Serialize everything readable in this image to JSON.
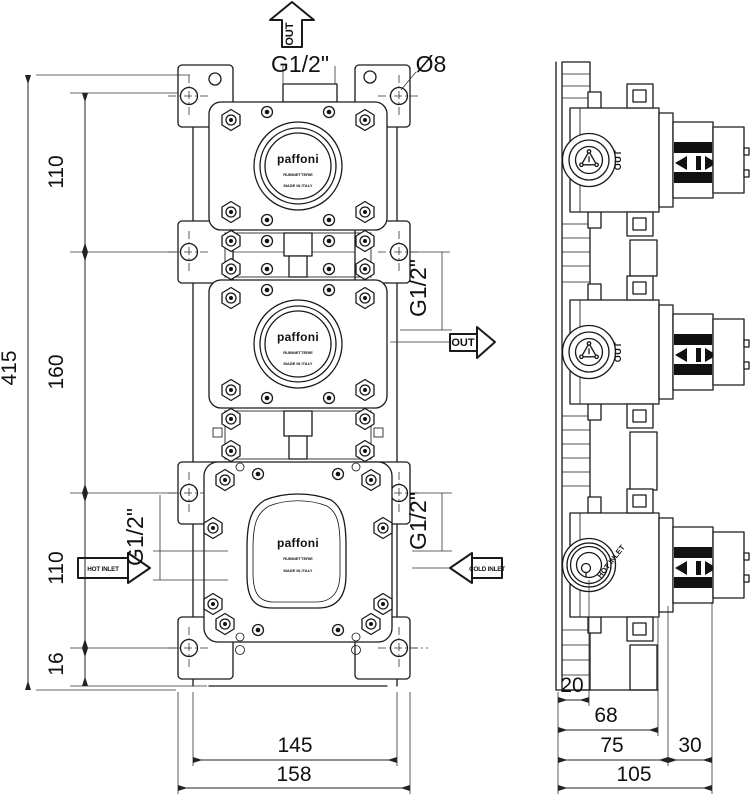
{
  "product": {
    "brand": "paffoni",
    "brand_sub": "RUBINETTERIE",
    "brand_origin": "MADE IN ITALY"
  },
  "labels": {
    "thread": "G1/2\"",
    "hole_diameter": "Ø8",
    "out": "OUT",
    "hot_inlet": "HOT INLET",
    "cold_inlet": "COLD INLET"
  },
  "dimensions_front_mm": {
    "total_height": "415",
    "spacing_top": "110",
    "spacing_middle": "160",
    "spacing_bottom": "110",
    "foot": "16",
    "inner_width": "145",
    "overall_width": "158"
  },
  "dimensions_side_mm": {
    "port_plane_offset": "20",
    "body_depth": "68",
    "rough_in_depth": "75",
    "cartridge_length": "30",
    "overall_depth": "105"
  }
}
